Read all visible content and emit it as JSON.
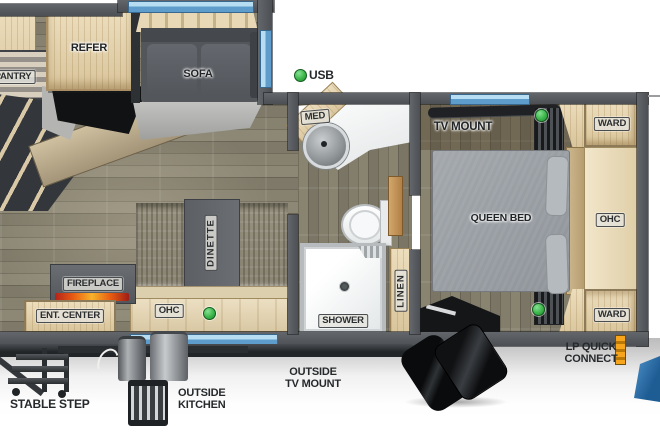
{
  "title": "RV travel trailer floor plan",
  "labels": {
    "pantry": "PANTRY",
    "refer": "REFER",
    "sofa": "SOFA",
    "usb": "USB",
    "med": "MED",
    "tv_mount": "TV MOUNT",
    "ward_top": "WARD",
    "ward_bottom": "WARD",
    "queen_bed": "QUEEN BED",
    "ohc_bedroom": "OHC",
    "ohc_living": "OHC",
    "dinette": "DINETTE",
    "fireplace": "FIREPLACE",
    "ent_center": "ENT. CENTER",
    "shower": "SHOWER",
    "linen": "LINEN"
  },
  "exterior_labels": {
    "stable_step": "STABLE STEP",
    "outside_kitchen": [
      "OUTSIDE",
      "KITCHEN"
    ],
    "outside_tv_mount": [
      "OUTSIDE",
      "TV MOUNT"
    ],
    "lp_quick_connect": [
      "LP QUICK",
      "CONNECT"
    ]
  },
  "indicators": {
    "usb_indicator_count": 4,
    "usb_indicator_color": "#3cb54a"
  },
  "colors": {
    "wall": "#54585c",
    "window_glass": "#79b6e0",
    "floor_wood": "#87826f",
    "cabinet_wood": "#e4d3b0",
    "sofa_upholstery": "#55585d",
    "bed_upholstery": "#9aa0a5",
    "flame_accent": "#e85c12",
    "brand_blue_corner": "#2d6ca5"
  }
}
